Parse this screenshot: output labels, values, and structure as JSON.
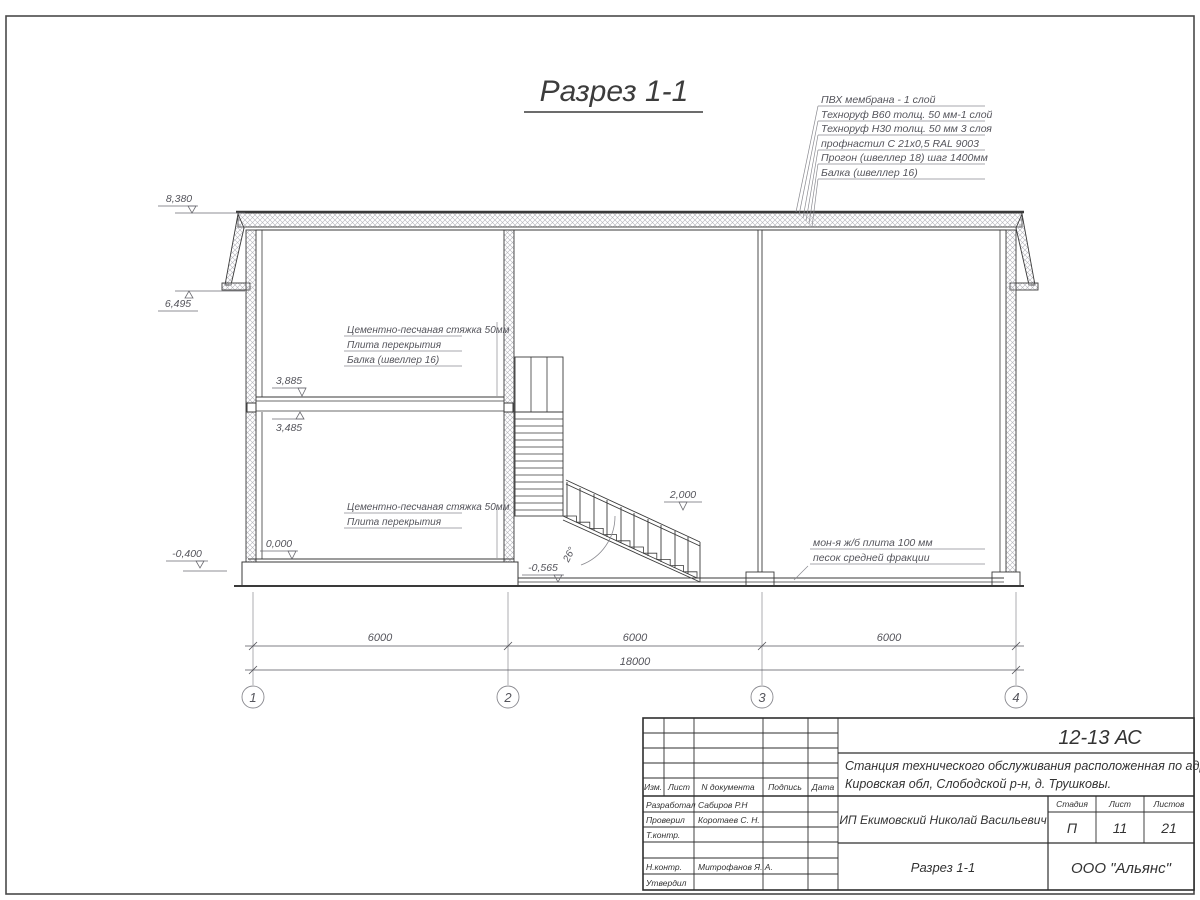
{
  "page": {
    "title": "Разрез 1-1"
  },
  "roof_legend": [
    "ПВХ мембрана - 1 слой",
    "Техноруф В60 толщ. 50 мм-1 слой",
    "Техноруф Н30 толщ. 50 мм 3 слоя",
    "профнастил С 21х0,5 RAL 9003",
    "Прогон (швеллер 18) шаг 1400мм",
    "Балка (швеллер 16)"
  ],
  "floor_labels_upper": [
    "Цементно-песчаная стяжка 50мм",
    "Плита перекрытия",
    "Балка (швеллер 16)"
  ],
  "floor_labels_lower": [
    "Цементно-песчаная стяжка 50мм",
    "Плита перекрытия"
  ],
  "ground_labels": [
    "мон-я ж/б плита 100 мм",
    "песок средней фракции"
  ],
  "elevations": {
    "roof_top": "8,380",
    "eave": "6,495",
    "slab_top": "3,885",
    "slab_bottom": "3,485",
    "floor": "0,000",
    "grade": "-0,400",
    "pit": "-0,565",
    "landing": "2,000"
  },
  "stair_angle": "26°",
  "dims": {
    "bay1": "6000",
    "bay2": "6000",
    "bay3": "6000",
    "total": "18000"
  },
  "axes": [
    "1",
    "2",
    "3",
    "4"
  ],
  "titleblock": {
    "code": "12-13 АС",
    "project_line1": "Станция технического обслуживания расположенная по адресу",
    "project_line2": "Кировская обл, Слободской р-н, д. Трушковы.",
    "client": "ИП Екимовский Николай Васильевич",
    "sheet_name": "Разрез 1-1",
    "organization": "ООО \"Альянс\"",
    "cols": {
      "izm": "Изм.",
      "list": "Лист",
      "doc": "N документа",
      "sign": "Подпись",
      "date": "Дата"
    },
    "stage_label": "Стадия",
    "sheet_label": "Лист",
    "sheets_label": "Листов",
    "stage": "П",
    "sheet": "11",
    "sheets": "21",
    "roles": {
      "developed": "Разработал",
      "checked": "Проверил",
      "tcontrol": "Т.контр.",
      "ncontrol": "Н.контр.",
      "approved": "Утвердил"
    },
    "names": {
      "developed": "Сабиров Р.Н",
      "checked": "Коротаев С. Н.",
      "ncontrol": "Митрофанов Я. А."
    }
  }
}
